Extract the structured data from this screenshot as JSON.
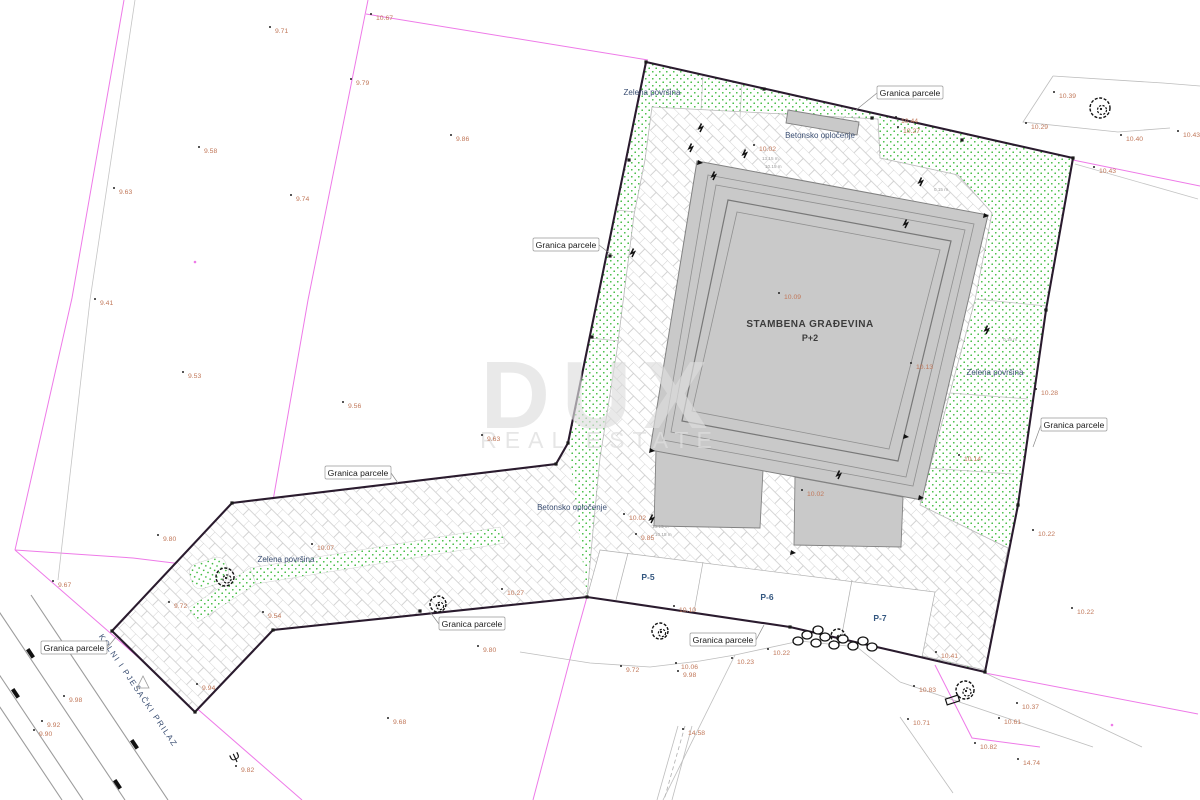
{
  "title": "Situacija - kopija katastarskog plana",
  "watermark": {
    "l1": "DUX",
    "l2": "REAL ESTATE"
  },
  "building": {
    "l1": "STAMBENA GRAĐEVINA",
    "l2": "P+2",
    "x": 810,
    "y": 327
  },
  "road": {
    "label": "KOLNI I PJEŠAČKI PRILAZ",
    "x": 136,
    "y": 692,
    "angle": 56
  },
  "labels": {
    "granica": {
      "text": "Granica parcele",
      "items": [
        {
          "x": 910,
          "y": 93,
          "lx": 856,
          "ly": 110
        },
        {
          "x": 566,
          "y": 245,
          "lx": 613,
          "ly": 256
        },
        {
          "x": 358,
          "y": 473,
          "lx": 398,
          "ly": 483
        },
        {
          "x": 74,
          "y": 648,
          "lx": 116,
          "ly": 637
        },
        {
          "x": 472,
          "y": 624,
          "lx": 430,
          "ly": 612
        },
        {
          "x": 723,
          "y": 640,
          "lx": 764,
          "ly": 625
        },
        {
          "x": 1074,
          "y": 425,
          "lx": 1033,
          "ly": 447
        }
      ]
    },
    "zelena": {
      "text": "Zelena površina",
      "items": [
        {
          "x": 652,
          "y": 95
        },
        {
          "x": 995,
          "y": 375
        },
        {
          "x": 286,
          "y": 562
        }
      ]
    },
    "beton": {
      "text": "Betonsko opločenje",
      "items": [
        {
          "x": 820,
          "y": 138
        },
        {
          "x": 572,
          "y": 510
        }
      ]
    },
    "parking": [
      {
        "t": "P-5",
        "x": 648,
        "y": 580
      },
      {
        "t": "P-6",
        "x": 767,
        "y": 600
      },
      {
        "t": "P-7",
        "x": 880,
        "y": 621
      }
    ]
  },
  "elevations": [
    {
      "v": "9.71",
      "x": 275,
      "y": 33
    },
    {
      "v": "10.67",
      "x": 376,
      "y": 20
    },
    {
      "v": "9.79",
      "x": 356,
      "y": 85
    },
    {
      "v": "9.58",
      "x": 204,
      "y": 153
    },
    {
      "v": "9.63",
      "x": 119,
      "y": 194
    },
    {
      "v": "9.74",
      "x": 296,
      "y": 201
    },
    {
      "v": "9.86",
      "x": 456,
      "y": 141
    },
    {
      "v": "10.39",
      "x": 1059,
      "y": 98
    },
    {
      "v": "10.29",
      "x": 1031,
      "y": 129
    },
    {
      "v": "10.40",
      "x": 1126,
      "y": 141
    },
    {
      "v": "10.43",
      "x": 1183,
      "y": 137
    },
    {
      "v": "10.43",
      "x": 1099,
      "y": 173
    },
    {
      "v": "9.41",
      "x": 100,
      "y": 305
    },
    {
      "v": "9.53",
      "x": 188,
      "y": 378
    },
    {
      "v": "9.56",
      "x": 348,
      "y": 408
    },
    {
      "v": "9.63",
      "x": 487,
      "y": 441
    },
    {
      "v": "10.28",
      "x": 1041,
      "y": 395
    },
    {
      "v": "10.14",
      "x": 964,
      "y": 461
    },
    {
      "v": "10.22",
      "x": 1038,
      "y": 536
    },
    {
      "v": "9.80",
      "x": 163,
      "y": 541
    },
    {
      "v": "9.67",
      "x": 58,
      "y": 587
    },
    {
      "v": "9.72",
      "x": 174,
      "y": 608
    },
    {
      "v": "9.54",
      "x": 268,
      "y": 618
    },
    {
      "v": "9.94",
      "x": 202,
      "y": 690
    },
    {
      "v": "9.98",
      "x": 69,
      "y": 702
    },
    {
      "v": "9.92",
      "x": 47,
      "y": 727
    },
    {
      "v": "9.90",
      "x": 39,
      "y": 736
    },
    {
      "v": "9.82",
      "x": 241,
      "y": 772
    },
    {
      "v": "10.07",
      "x": 317,
      "y": 550
    },
    {
      "v": "10.27",
      "x": 507,
      "y": 595
    },
    {
      "v": "9.80",
      "x": 483,
      "y": 652
    },
    {
      "v": "9.68",
      "x": 393,
      "y": 724
    },
    {
      "v": "9.72",
      "x": 626,
      "y": 672
    },
    {
      "v": "10.06",
      "x": 681,
      "y": 669
    },
    {
      "v": "9.98",
      "x": 683,
      "y": 677
    },
    {
      "v": "10.23",
      "x": 737,
      "y": 664
    },
    {
      "v": "10.22",
      "x": 773,
      "y": 655
    },
    {
      "v": "14.58",
      "x": 688,
      "y": 735
    },
    {
      "v": "10.10",
      "x": 679,
      "y": 612
    },
    {
      "v": "10.22",
      "x": 1077,
      "y": 614
    },
    {
      "v": "10.41",
      "x": 941,
      "y": 658
    },
    {
      "v": "10.83",
      "x": 919,
      "y": 692
    },
    {
      "v": "10.71",
      "x": 913,
      "y": 725
    },
    {
      "v": "10.61",
      "x": 1004,
      "y": 724
    },
    {
      "v": "10.37",
      "x": 1022,
      "y": 709
    },
    {
      "v": "10.82",
      "x": 980,
      "y": 749
    },
    {
      "v": "14.74",
      "x": 1023,
      "y": 765
    },
    {
      "v": "10.02",
      "x": 759,
      "y": 151
    },
    {
      "v": "10.44",
      "x": 901,
      "y": 123
    },
    {
      "v": "10.27",
      "x": 903,
      "y": 133
    },
    {
      "v": "10.02",
      "x": 629,
      "y": 520
    },
    {
      "v": "9.85",
      "x": 641,
      "y": 540
    },
    {
      "v": "10.02",
      "x": 807,
      "y": 496
    },
    {
      "v": "10.09",
      "x": 784,
      "y": 299
    },
    {
      "v": "10.13",
      "x": 916,
      "y": 369
    }
  ],
  "notes": [
    {
      "t": "13.15 m",
      "x": 762,
      "y": 160
    },
    {
      "t": "10.15 m",
      "x": 765,
      "y": 168
    },
    {
      "t": "0.15 m",
      "x": 934,
      "y": 191
    },
    {
      "t": "0.15 m",
      "x": 1003,
      "y": 341
    },
    {
      "t": "13.15 m",
      "x": 652,
      "y": 528
    },
    {
      "t": "10.15 m",
      "x": 655,
      "y": 536
    }
  ],
  "symbols": {
    "trees": [
      {
        "x": 1100,
        "y": 108,
        "r": 10
      },
      {
        "x": 225,
        "y": 577,
        "r": 9
      },
      {
        "x": 438,
        "y": 604,
        "r": 8
      },
      {
        "x": 660,
        "y": 631,
        "r": 8
      },
      {
        "x": 965,
        "y": 690,
        "r": 9
      },
      {
        "x": 838,
        "y": 636,
        "r": 7
      }
    ],
    "shrubs": [
      [
        798,
        641
      ],
      [
        807,
        635
      ],
      [
        816,
        643
      ],
      [
        825,
        637
      ],
      [
        834,
        645
      ],
      [
        843,
        639
      ],
      [
        853,
        646
      ],
      [
        863,
        641
      ],
      [
        872,
        647
      ],
      [
        818,
        630
      ]
    ],
    "ticks": [
      [
        646,
        62
      ],
      [
        764,
        89
      ],
      [
        872,
        118
      ],
      [
        962,
        140
      ],
      [
        1073,
        158
      ],
      [
        1046,
        310
      ],
      [
        1018,
        505
      ],
      [
        985,
        672
      ],
      [
        790,
        627
      ],
      [
        587,
        597
      ],
      [
        420,
        611
      ],
      [
        273,
        630
      ],
      [
        195,
        712
      ],
      [
        112,
        631
      ],
      [
        232,
        503
      ],
      [
        556,
        464
      ],
      [
        568,
        443
      ],
      [
        592,
        337
      ],
      [
        610,
        256
      ],
      [
        629,
        160
      ]
    ],
    "marks": [
      [
        632,
        257
      ],
      [
        713,
        180
      ],
      [
        744,
        158
      ],
      [
        920,
        186
      ],
      [
        986,
        334
      ],
      [
        838,
        479
      ],
      [
        651,
        523
      ],
      [
        905,
        228
      ],
      [
        690,
        152
      ],
      [
        700,
        132
      ]
    ],
    "arrows": [
      [
        906,
        437
      ],
      [
        793,
        553
      ],
      [
        700,
        163
      ],
      [
        986,
        216
      ],
      [
        921,
        498
      ],
      [
        652,
        451
      ]
    ],
    "magenta_dots": [
      [
        195,
        262
      ],
      [
        1112,
        725
      ]
    ],
    "lamp": {
      "glyph": "Ψ",
      "x": 237,
      "y": 762
    },
    "triangle": {
      "x": 143,
      "y": 683
    },
    "box": {
      "x": 946,
      "y": 697,
      "w": 13,
      "h": 6
    }
  },
  "colors": {
    "parcel_boundary": "#2a1b2e",
    "cadastral_line": "#ee7ae8",
    "cadastral_gray": "#b9b9b9",
    "grass_dot": "#2db52d",
    "pave_line": "#c9c9c9",
    "building_fill": "#c9c9c9",
    "building_edge": "#808080",
    "elevation_text": "#c1785a",
    "blue_text": "#3b4f73",
    "parking_text": "#33567f",
    "bubble_border": "#999999",
    "road_line": "#9c9c9c",
    "watermark": "#dedede"
  }
}
